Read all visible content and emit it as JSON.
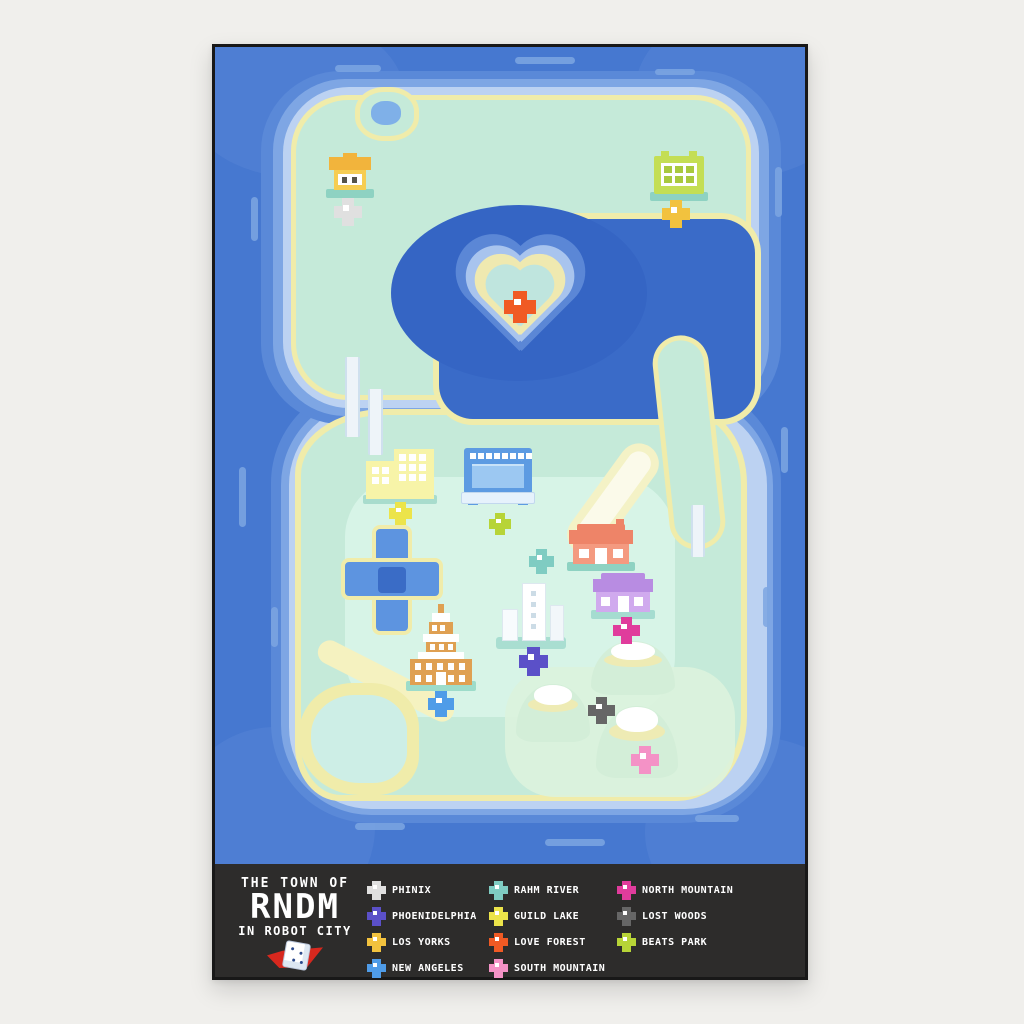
{
  "poster": {
    "title": {
      "line1": "THE TOWN OF",
      "line2": "RNDM",
      "line3": "IN ROBOT CITY"
    },
    "legend_columns": [
      {
        "items": [
          {
            "id": "phinix",
            "label": "PHINIX",
            "color": "#e0e0e0"
          },
          {
            "id": "phoenidelphia",
            "label": "PHOENIDELPHIA",
            "color": "#5b50c8"
          },
          {
            "id": "los-yorks",
            "label": "LOS YORKS",
            "color": "#f2c23e"
          },
          {
            "id": "new-angeles",
            "label": "NEW ANGELES",
            "color": "#4f9ce8"
          }
        ]
      },
      {
        "items": [
          {
            "id": "rahm-river",
            "label": "RAHM RIVER",
            "color": "#7fccc2"
          },
          {
            "id": "guild-lake",
            "label": "GUILD LAKE",
            "color": "#ece44a"
          },
          {
            "id": "love-forest",
            "label": "LOVE FOREST",
            "color": "#f05a24"
          },
          {
            "id": "south-mountain",
            "label": "SOUTH MOUNTAIN",
            "color": "#f492c6"
          }
        ]
      },
      {
        "items": [
          {
            "id": "north-mountain",
            "label": "NORTH MOUNTAIN",
            "color": "#e03c9c"
          },
          {
            "id": "lost-woods",
            "label": "LOST WOODS",
            "color": "#666666"
          },
          {
            "id": "beats-park",
            "label": "BEATS PARK",
            "color": "#b7d437"
          }
        ]
      }
    ],
    "map_markers": [
      {
        "id": "phinix",
        "color": "#e0e0e0",
        "x": 119,
        "y": 151,
        "size": 28
      },
      {
        "id": "los-yorks",
        "color": "#f2c23e",
        "x": 447,
        "y": 153,
        "size": 28
      },
      {
        "id": "love-forest",
        "color": "#f05a24",
        "x": 289,
        "y": 244,
        "size": 32
      },
      {
        "id": "guild-lake",
        "color": "#ece44a",
        "x": 174,
        "y": 455,
        "size": 23
      },
      {
        "id": "beats-park",
        "color": "#b7d437",
        "x": 274,
        "y": 466,
        "size": 22
      },
      {
        "id": "rahm-river",
        "color": "#7fccc2",
        "x": 314,
        "y": 502,
        "size": 25
      },
      {
        "id": "north-mountain",
        "color": "#e03c9c",
        "x": 398,
        "y": 570,
        "size": 27
      },
      {
        "id": "phoenidelphia",
        "color": "#5b50c8",
        "x": 304,
        "y": 600,
        "size": 29
      },
      {
        "id": "new-angeles",
        "color": "#4f9ce8",
        "x": 213,
        "y": 644,
        "size": 26
      },
      {
        "id": "lost-woods",
        "color": "#666666",
        "x": 373,
        "y": 650,
        "size": 27
      },
      {
        "id": "south-mountain",
        "color": "#f492c6",
        "x": 416,
        "y": 699,
        "size": 28
      }
    ],
    "palette": {
      "ocean": "#4678d0",
      "lagoon": "#3a6bc8",
      "shallow": "#7ea6e4",
      "shore": "#bcd2f2",
      "sand": "#f0ecaa",
      "land": "#c5ead9",
      "land_light": "#d8f4e8",
      "legend_bg": "#2d2c2b",
      "legend_text": "#ffffff",
      "logo_red": "#d7281e"
    }
  }
}
